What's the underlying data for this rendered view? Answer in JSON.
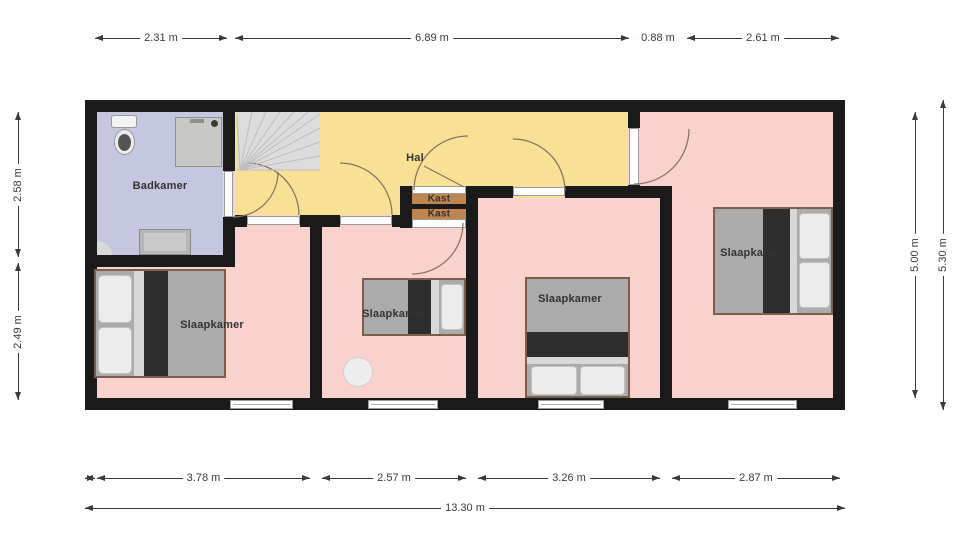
{
  "meta": {
    "width": 960,
    "height": 539,
    "type": "floor-plan"
  },
  "colors": {
    "wall": "#1a1a1a",
    "room_pink": "#f9d2ce",
    "hall_yellow": "#f8e195",
    "bathroom_blue": "#c5c6e0",
    "closet_tan": "#c0854e",
    "stairs_gray": "#dcdcdc",
    "dimension_text": "#3a3a3a"
  },
  "rooms": [
    {
      "label": "Badkamer"
    },
    {
      "label": "Hal"
    },
    {
      "label": "Kast"
    },
    {
      "label": "Kast"
    },
    {
      "label": "Slaapkamer"
    },
    {
      "label": "Slaapkamer"
    },
    {
      "label": "Slaapkamer"
    },
    {
      "label": "Slaapkamer"
    }
  ],
  "plan": {
    "rects": [
      {
        "name": "room-fill-base",
        "x": 97,
        "y": 112,
        "w": 736,
        "h": 286,
        "fill": "#f9d2ce"
      },
      {
        "name": "hall-fill",
        "x": 235,
        "y": 112,
        "w": 393,
        "h": 103,
        "fill": "#f8e195"
      },
      {
        "name": "bedroom3-top-patch",
        "x": 478,
        "y": 198,
        "w": 150,
        "h": 17,
        "fill": "#f9d2ce"
      },
      {
        "name": "bathroom-fill",
        "x": 97,
        "y": 112,
        "w": 126,
        "h": 143,
        "fill": "#c5c6e0"
      },
      {
        "name": "stairs-fill",
        "x": 237,
        "y": 112,
        "w": 83,
        "h": 58,
        "fill": "#dcdcdc"
      },
      {
        "name": "closet-wall-left",
        "x": 400,
        "y": 186,
        "w": 12,
        "h": 42,
        "fill": "#1a1a1a"
      },
      {
        "name": "closet-wall-right",
        "x": 466,
        "y": 186,
        "w": 12,
        "h": 42,
        "fill": "#1a1a1a"
      },
      {
        "name": "closet-fill-1",
        "x": 412,
        "y": 194,
        "w": 54,
        "h": 10,
        "fill": "#c0854e"
      },
      {
        "name": "closet-divider",
        "x": 412,
        "y": 204,
        "w": 54,
        "h": 5,
        "fill": "#1a1a1a"
      },
      {
        "name": "closet-fill-2",
        "x": 412,
        "y": 209,
        "w": 54,
        "h": 10,
        "fill": "#c0854e"
      },
      {
        "name": "wall-outer-top",
        "x": 85,
        "y": 100,
        "w": 760,
        "h": 12,
        "fill": "#1a1a1a"
      },
      {
        "name": "wall-outer-bottom",
        "x": 85,
        "y": 398,
        "w": 760,
        "h": 12,
        "fill": "#1a1a1a"
      },
      {
        "name": "wall-outer-left",
        "x": 85,
        "y": 100,
        "w": 12,
        "h": 310,
        "fill": "#1a1a1a"
      },
      {
        "name": "wall-outer-right",
        "x": 833,
        "y": 100,
        "w": 12,
        "h": 310,
        "fill": "#1a1a1a"
      },
      {
        "name": "wall-bathroom-right-upper",
        "x": 223,
        "y": 112,
        "w": 12,
        "h": 59,
        "fill": "#1a1a1a"
      },
      {
        "name": "wall-bathroom-right-lower",
        "x": 223,
        "y": 217,
        "w": 12,
        "h": 50,
        "fill": "#1a1a1a"
      },
      {
        "name": "wall-bathroom-bottom",
        "x": 85,
        "y": 255,
        "w": 150,
        "h": 12,
        "fill": "#1a1a1a"
      },
      {
        "name": "wall-hall-bottom-a",
        "x": 235,
        "y": 215,
        "w": 12,
        "h": 12,
        "fill": "#1a1a1a"
      },
      {
        "name": "wall-hall-bottom-b",
        "x": 300,
        "y": 215,
        "w": 40,
        "h": 12,
        "fill": "#1a1a1a"
      },
      {
        "name": "wall-hall-bottom-c",
        "x": 392,
        "y": 215,
        "w": 20,
        "h": 12,
        "fill": "#1a1a1a"
      },
      {
        "name": "wall-bedroom1-2",
        "x": 310,
        "y": 215,
        "w": 12,
        "h": 195,
        "fill": "#1a1a1a"
      },
      {
        "name": "wall-hall-bottom-d",
        "x": 478,
        "y": 186,
        "w": 35,
        "h": 12,
        "fill": "#1a1a1a"
      },
      {
        "name": "wall-hall-bottom-e",
        "x": 565,
        "y": 186,
        "w": 107,
        "h": 12,
        "fill": "#1a1a1a"
      },
      {
        "name": "wall-bedroom2-3",
        "x": 466,
        "y": 186,
        "w": 12,
        "h": 224,
        "fill": "#1a1a1a"
      },
      {
        "name": "wall-bedroom3-4",
        "x": 660,
        "y": 186,
        "w": 12,
        "h": 224,
        "fill": "#1a1a1a"
      },
      {
        "name": "wall-hall-end-upper",
        "x": 628,
        "y": 112,
        "w": 12,
        "h": 16,
        "fill": "#1a1a1a"
      },
      {
        "name": "wall-hall-end-lower",
        "x": 628,
        "y": 185,
        "w": 12,
        "h": 13,
        "fill": "#1a1a1a"
      },
      {
        "name": "door-bathroom",
        "x": 224,
        "y": 171,
        "w": 9,
        "h": 46,
        "fill": "#ffffff",
        "stroke": "#9a9a9a"
      },
      {
        "name": "door-bedroom1",
        "x": 247,
        "y": 216,
        "w": 53,
        "h": 9,
        "fill": "#ffffff",
        "stroke": "#9a9a9a"
      },
      {
        "name": "door-bedroom2",
        "x": 340,
        "y": 216,
        "w": 52,
        "h": 9,
        "fill": "#ffffff",
        "stroke": "#9a9a9a"
      },
      {
        "name": "door-closet-top",
        "x": 412,
        "y": 186,
        "w": 54,
        "h": 8,
        "fill": "#ffffff",
        "stroke": "#9a9a9a"
      },
      {
        "name": "door-closet-bottom",
        "x": 412,
        "y": 219,
        "w": 54,
        "h": 9,
        "fill": "#ffffff",
        "stroke": "#9a9a9a"
      },
      {
        "name": "door-bedroom3",
        "x": 513,
        "y": 187,
        "w": 52,
        "h": 9,
        "fill": "#ffffff",
        "stroke": "#9a9a9a"
      },
      {
        "name": "door-bedroom4",
        "x": 629,
        "y": 128,
        "w": 10,
        "h": 57,
        "fill": "#ffffff",
        "stroke": "#9a9a9a"
      },
      {
        "name": "window-bedroom1",
        "x": 230,
        "y": 400,
        "w": 63,
        "h": 9,
        "fill": "#ffffff",
        "stroke": "#9a9a9a"
      },
      {
        "name": "window-bedroom1-line",
        "x": 233,
        "y": 404,
        "w": 57,
        "h": 1,
        "fill": "#b0b0b0"
      },
      {
        "name": "window-bedroom2",
        "x": 368,
        "y": 400,
        "w": 70,
        "h": 9,
        "fill": "#ffffff",
        "stroke": "#9a9a9a"
      },
      {
        "name": "window-bedroom2-line",
        "x": 371,
        "y": 404,
        "w": 64,
        "h": 1,
        "fill": "#b0b0b0"
      },
      {
        "name": "window-bedroom3",
        "x": 538,
        "y": 400,
        "w": 66,
        "h": 9,
        "fill": "#ffffff",
        "stroke": "#9a9a9a"
      },
      {
        "name": "window-bedroom3-line",
        "x": 541,
        "y": 404,
        "w": 60,
        "h": 1,
        "fill": "#b0b0b0"
      },
      {
        "name": "window-bedroom4",
        "x": 728,
        "y": 400,
        "w": 69,
        "h": 9,
        "fill": "#ffffff",
        "stroke": "#9a9a9a"
      },
      {
        "name": "window-bedroom4-line",
        "x": 731,
        "y": 404,
        "w": 63,
        "h": 1,
        "fill": "#b0b0b0"
      },
      {
        "name": "shower",
        "x": 175,
        "y": 117,
        "w": 47,
        "h": 50,
        "fill": "#c8c8c4",
        "stroke": "#909090"
      },
      {
        "name": "shower-faucet-dot",
        "x": 211,
        "y": 120,
        "w": 7,
        "h": 7,
        "fill": "#3c3c3c",
        "radius": "50%"
      },
      {
        "name": "shower-handle",
        "x": 190,
        "y": 119,
        "w": 14,
        "h": 4,
        "fill": "#8f8f8f"
      },
      {
        "name": "toilet-tank",
        "x": 111,
        "y": 115,
        "w": 26,
        "h": 13,
        "fill": "#f4f4f4",
        "stroke": "#999999",
        "radius": "3px"
      },
      {
        "name": "toilet-bowl",
        "x": 114,
        "y": 129,
        "w": 21,
        "h": 26,
        "fill": "#ececec",
        "stroke": "#999999",
        "radius": "50%"
      },
      {
        "name": "toilet-bowl-inner",
        "x": 118,
        "y": 134,
        "w": 13,
        "h": 17,
        "fill": "#555555",
        "radius": "50%"
      },
      {
        "name": "bathroom-vanity",
        "x": 139,
        "y": 229,
        "w": 52,
        "h": 26,
        "fill": "#b7b7b7",
        "stroke": "#8a8a8a"
      },
      {
        "name": "bathroom-vanity-inner",
        "x": 144,
        "y": 233,
        "w": 42,
        "h": 18,
        "fill": "#cacaca"
      },
      {
        "name": "bathroom-corner-shelf",
        "x": 97,
        "y": 241,
        "w": 15,
        "h": 14,
        "fill": "#d9d9d9",
        "radius": "0 100% 0 0"
      },
      {
        "name": "bed1-frame",
        "x": 94,
        "y": 269,
        "w": 132,
        "h": 109,
        "fill": "#7b6047"
      },
      {
        "name": "bed1-mattress",
        "x": 96,
        "y": 271,
        "w": 128,
        "h": 105,
        "fill": "#ababab"
      },
      {
        "name": "bed1-sheet",
        "x": 134,
        "y": 271,
        "w": 10,
        "h": 105,
        "fill": "#d8d8d8"
      },
      {
        "name": "bed1-duvet",
        "x": 144,
        "y": 271,
        "w": 24,
        "h": 105,
        "fill": "#2d2d2d"
      },
      {
        "name": "bed1-pillow-1",
        "x": 98,
        "y": 275,
        "w": 34,
        "h": 48,
        "fill": "#ececec",
        "stroke": "#c3c3c3",
        "radius": "5px"
      },
      {
        "name": "bed1-pillow-2",
        "x": 98,
        "y": 327,
        "w": 34,
        "h": 47,
        "fill": "#ececec",
        "stroke": "#c3c3c3",
        "radius": "5px"
      },
      {
        "name": "bed2-frame",
        "x": 362,
        "y": 278,
        "w": 104,
        "h": 58,
        "fill": "#7b6047"
      },
      {
        "name": "bed2-mattress",
        "x": 364,
        "y": 280,
        "w": 100,
        "h": 54,
        "fill": "#ababab"
      },
      {
        "name": "bed2-duvet",
        "x": 408,
        "y": 280,
        "w": 23,
        "h": 54,
        "fill": "#2d2d2d"
      },
      {
        "name": "bed2-sheet",
        "x": 431,
        "y": 280,
        "w": 8,
        "h": 54,
        "fill": "#d8d8d8"
      },
      {
        "name": "bed2-pillow",
        "x": 441,
        "y": 284,
        "w": 22,
        "h": 46,
        "fill": "#ececec",
        "stroke": "#c3c3c3",
        "radius": "4px"
      },
      {
        "name": "bed3-frame",
        "x": 525,
        "y": 277,
        "w": 105,
        "h": 121,
        "fill": "#7b6047"
      },
      {
        "name": "bed3-mattress",
        "x": 527,
        "y": 279,
        "w": 101,
        "h": 117,
        "fill": "#ababab"
      },
      {
        "name": "bed3-duvet",
        "x": 527,
        "y": 332,
        "w": 101,
        "h": 25,
        "fill": "#2d2d2d"
      },
      {
        "name": "bed3-sheet",
        "x": 527,
        "y": 357,
        "w": 101,
        "h": 7,
        "fill": "#d8d8d8"
      },
      {
        "name": "bed3-pillow-1",
        "x": 531,
        "y": 366,
        "w": 46,
        "h": 29,
        "fill": "#ececec",
        "stroke": "#c3c3c3",
        "radius": "4px"
      },
      {
        "name": "bed3-pillow-2",
        "x": 580,
        "y": 366,
        "w": 45,
        "h": 29,
        "fill": "#ececec",
        "stroke": "#c3c3c3",
        "radius": "4px"
      },
      {
        "name": "bed4-frame",
        "x": 713,
        "y": 207,
        "w": 120,
        "h": 108,
        "fill": "#7b6047"
      },
      {
        "name": "bed4-mattress",
        "x": 715,
        "y": 209,
        "w": 116,
        "h": 104,
        "fill": "#ababab"
      },
      {
        "name": "bed4-duvet",
        "x": 763,
        "y": 209,
        "w": 27,
        "h": 104,
        "fill": "#2d2d2d"
      },
      {
        "name": "bed4-sheet",
        "x": 790,
        "y": 209,
        "w": 7,
        "h": 104,
        "fill": "#d8d8d8"
      },
      {
        "name": "bed4-pillow-1",
        "x": 799,
        "y": 213,
        "w": 31,
        "h": 46,
        "fill": "#ececec",
        "stroke": "#c3c3c3",
        "radius": "4px"
      },
      {
        "name": "bed4-pillow-2",
        "x": 799,
        "y": 262,
        "w": 31,
        "h": 46,
        "fill": "#ececec",
        "stroke": "#c3c3c3",
        "radius": "4px"
      },
      {
        "name": "bedroom2-stool",
        "x": 343,
        "y": 357,
        "w": 30,
        "h": 30,
        "fill": "#ededed",
        "stroke": "#d0d0d0",
        "radius": "50%"
      }
    ],
    "arcs": [
      {
        "name": "arc-bathroom-door",
        "m": [
          278,
          172
        ],
        "r": 45,
        "to": [
          233,
          217
        ]
      },
      {
        "name": "arc-bedroom1-door",
        "m": [
          247,
          163
        ],
        "r": 52,
        "to": [
          299,
          215
        ]
      },
      {
        "name": "arc-bedroom2-door",
        "m": [
          340,
          163
        ],
        "r": 52,
        "to": [
          392,
          215
        ]
      },
      {
        "name": "arc-closet-top-door",
        "m": [
          414,
          190
        ],
        "r": 54,
        "to": [
          468,
          136
        ]
      },
      {
        "name": "arc-closet-bottom-door",
        "m": [
          463,
          223
        ],
        "r": 51,
        "to": [
          412,
          274
        ]
      },
      {
        "name": "arc-bedroom3-door",
        "m": [
          513,
          139
        ],
        "r": 52,
        "to": [
          565,
          191
        ]
      },
      {
        "name": "arc-bedroom4-door",
        "m": [
          689,
          129
        ],
        "r": 55,
        "to": [
          634,
          184
        ]
      }
    ],
    "lines": [
      {
        "p": [
          240,
          170,
          237,
          116
        ],
        "c": "#bdbdbd"
      },
      {
        "p": [
          240,
          170,
          252,
          112
        ],
        "c": "#bdbdbd"
      },
      {
        "p": [
          240,
          170,
          266,
          112
        ],
        "c": "#bdbdbd"
      },
      {
        "p": [
          240,
          170,
          280,
          112
        ],
        "c": "#bdbdbd"
      },
      {
        "p": [
          240,
          170,
          294,
          112
        ],
        "c": "#bdbdbd"
      },
      {
        "p": [
          240,
          170,
          308,
          112
        ],
        "c": "#bdbdbd"
      },
      {
        "p": [
          240,
          170,
          320,
          114
        ],
        "c": "#bdbdbd"
      },
      {
        "p": [
          240,
          170,
          320,
          128
        ],
        "c": "#bdbdbd"
      },
      {
        "p": [
          240,
          170,
          320,
          142
        ],
        "c": "#bdbdbd"
      },
      {
        "p": [
          240,
          170,
          320,
          156
        ],
        "c": "#bdbdbd"
      },
      {
        "p": [
          237,
          170,
          320,
          170
        ],
        "c": "#bdbdbd"
      },
      {
        "p": [
          424,
          166,
          464,
          187
        ],
        "c": "#84715f"
      }
    ],
    "labels": [
      {
        "text": "Badkamer",
        "x": 160,
        "y": 186,
        "size": 11
      },
      {
        "text": "Hal",
        "x": 415,
        "y": 158,
        "size": 11
      },
      {
        "text": "Kast",
        "x": 439,
        "y": 199,
        "size": 10
      },
      {
        "text": "Kast",
        "x": 439,
        "y": 214,
        "size": 10
      },
      {
        "text": "Slaapkamer",
        "x": 212,
        "y": 325,
        "size": 11
      },
      {
        "text": "Slaapkamer",
        "x": 394,
        "y": 314,
        "size": 11
      },
      {
        "text": "Slaapkamer",
        "x": 570,
        "y": 299,
        "size": 11
      },
      {
        "text": "Slaapkamer",
        "x": 752,
        "y": 253,
        "size": 11
      }
    ]
  },
  "dims": [
    {
      "dir": "h",
      "x1": 95,
      "x2": 227,
      "y": 38,
      "label": "2.31 m"
    },
    {
      "dir": "h",
      "x1": 235,
      "x2": 629,
      "y": 38,
      "label": "6.89 m"
    },
    {
      "dir": "h",
      "x1": 637,
      "x2": 679,
      "y": 38,
      "label": "0.88 m"
    },
    {
      "dir": "h",
      "x1": 687,
      "x2": 839,
      "y": 38,
      "label": "2.61 m"
    },
    {
      "dir": "v",
      "y1": 112,
      "y2": 257,
      "x": 18,
      "label": "2.58 m"
    },
    {
      "dir": "v",
      "y1": 263,
      "y2": 400,
      "x": 18,
      "label": "2.49 m"
    },
    {
      "dir": "v",
      "y1": 112,
      "y2": 398,
      "x": 915,
      "label": "5.00 m"
    },
    {
      "dir": "v",
      "y1": 100,
      "y2": 410,
      "x": 943,
      "label": "5.30 m"
    },
    {
      "dir": "h",
      "x1": 85,
      "x2": 95,
      "y": 478,
      "label": ""
    },
    {
      "dir": "h",
      "x1": 97,
      "x2": 310,
      "y": 478,
      "label": "3.78 m"
    },
    {
      "dir": "h",
      "x1": 322,
      "x2": 466,
      "y": 478,
      "label": "2.57 m"
    },
    {
      "dir": "h",
      "x1": 478,
      "x2": 660,
      "y": 478,
      "label": "3.26 m"
    },
    {
      "dir": "h",
      "x1": 672,
      "x2": 840,
      "y": 478,
      "label": "2.87 m"
    },
    {
      "dir": "h",
      "x1": 85,
      "x2": 845,
      "y": 508,
      "label": "13.30 m"
    }
  ]
}
